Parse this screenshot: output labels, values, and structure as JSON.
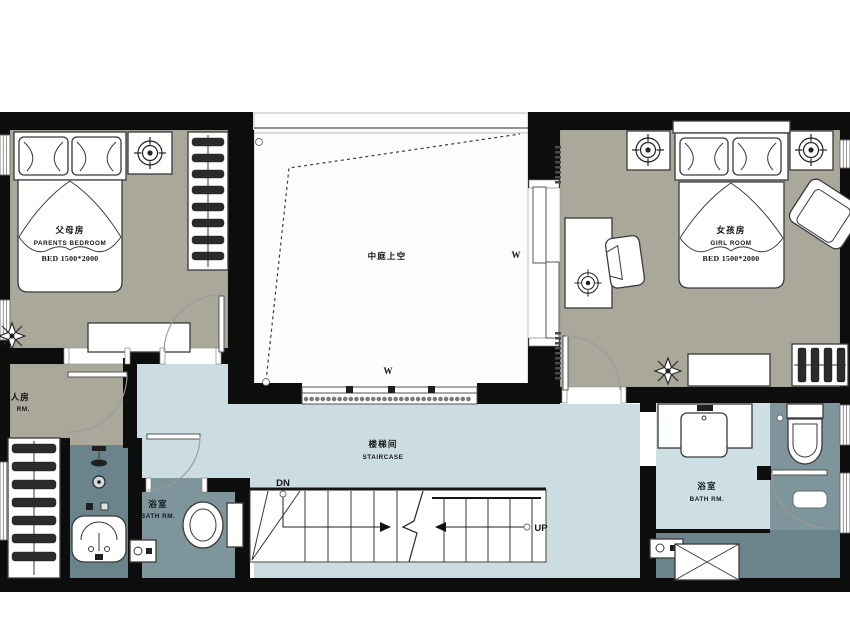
{
  "plan": {
    "type": "residential-floor-plan",
    "colors": {
      "wall": "#0d0d0d",
      "bedroom_floor": "#a9a89a",
      "hall_floor": "#ccdde1",
      "atrium_floor": "#fdfdfc",
      "bath_floor": "#7e959c",
      "bath_floor_dark": "#6b838a",
      "vanity_floor": "#cfe0e4",
      "furniture_outline": "#3a3a3a"
    },
    "rooms": {
      "parents_bedroom": {
        "label_zh": "父母房",
        "label_en": "PARENTS BEDROOM",
        "bed_spec": "BED 1500*2000"
      },
      "girl_room": {
        "label_zh": "女孩房",
        "label_en": "GIRL ROOM",
        "bed_spec": "BED 1500*2000"
      },
      "atrium": {
        "label_zh": "中庭上空",
        "window_mark": "W"
      },
      "stair_hall": {
        "label_zh": "楼梯间",
        "label_en": "STAIRCASE",
        "down_mark": "DN",
        "up_mark": "UP"
      },
      "bath_left": {
        "label_zh": "浴室",
        "label_en": "BATH RM."
      },
      "bath_right": {
        "label_zh": "浴室",
        "label_en": "BATH RM."
      },
      "side_room_partial": {
        "label_zh": "人房",
        "label_en": "RM."
      }
    }
  }
}
